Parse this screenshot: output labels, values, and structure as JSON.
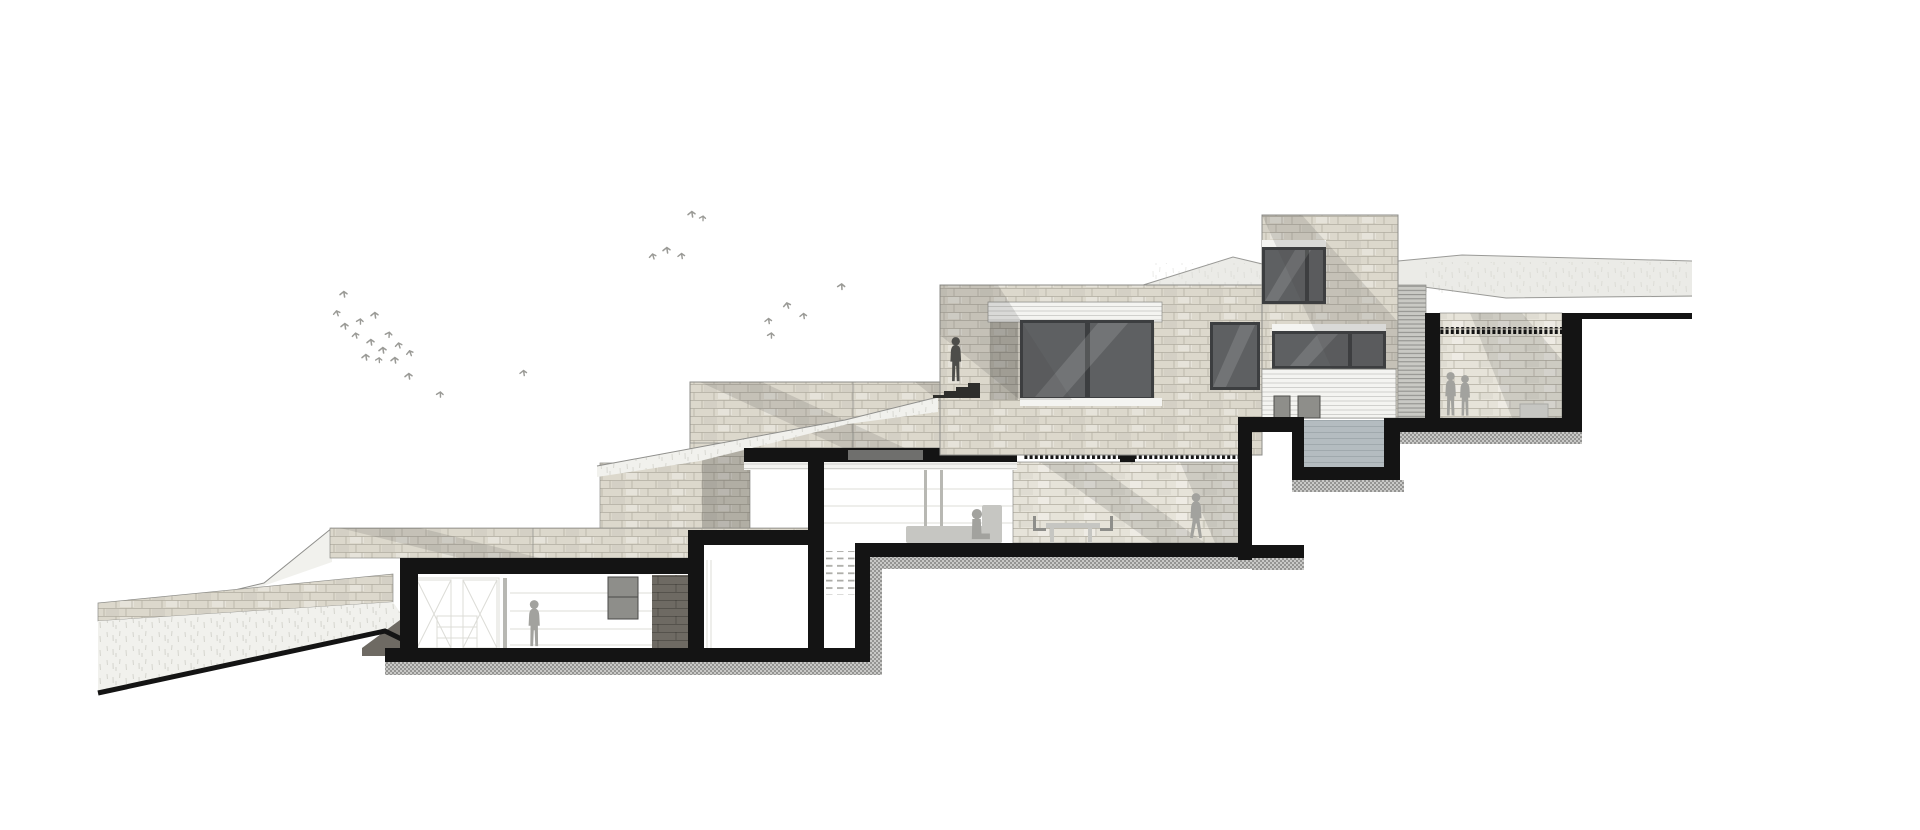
{
  "title": "Stepped hillside house — sectional elevation drawing",
  "drawing_type": "architectural-section",
  "canvas": {
    "width": 1920,
    "height": 830
  },
  "colors": {
    "paper": "#ffffff",
    "poche": "#141414",
    "stone": "#dcd8cc",
    "stoneLight": "#e6e3d9",
    "stoneDark": "#6e6a63",
    "mortar": "#b1ada0",
    "edge": "#8d8d89",
    "hill": "#ebebe7",
    "hillLine": "#9a9a97",
    "lawn": "#f1f1ed",
    "lawnLine": "#8f8f8c",
    "grassTick": "#c9c9c1",
    "glass": "#5e6062",
    "glassFrame": "#3c3e40",
    "glassStreak": "rgba(255,255,255,0.13)",
    "sill": "#f4f4f1",
    "sidingLine": "#c8c8c4",
    "louver": "#c9c9c4",
    "louverLine": "#8d8d89",
    "water": "#b4bcc0",
    "waterLine": "#9aa3a7",
    "hatchDark": "#949492",
    "hatchLight": "#c9c9c7",
    "person": "#a2a29e",
    "personDark": "#4d4d4a",
    "furniture": "#c6c6c2",
    "furnitureDark": "#8e8e8a",
    "mullion": "#b8b8b3",
    "interiorLine": "#dcdcd7",
    "tread": "#a9a9a4",
    "bird": "#9a9a96",
    "shadow": "rgba(70,70,66,0.15)",
    "shadowDeep": "rgba(40,40,38,0.24)"
  },
  "scene": {
    "levels": [
      {
        "id": "lower-bedroom-level",
        "features": [
          "wardrobe-x-doors",
          "drawer-unit",
          "standing-person",
          "dark-cabinet",
          "shelf-lines"
        ]
      },
      {
        "id": "middle-living-level",
        "features": [
          "open-stair",
          "clerestory-glazing",
          "sofa",
          "seated-person",
          "terrace-stone-wall",
          "walking-person",
          "outdoor-table",
          "guard-railing"
        ]
      },
      {
        "id": "upper-entry-level",
        "features": [
          "large-picture-window",
          "secondary-window",
          "entry-steps",
          "person-on-steps",
          "white-fascia"
        ]
      },
      {
        "id": "stone-tower",
        "features": [
          "upper-window",
          "ribbon-window",
          "lap-siding-base",
          "planter-boxes",
          "louver-screen"
        ]
      },
      {
        "id": "sunken-courtyard",
        "features": [
          "guard-railing",
          "couple-silhouette",
          "bench",
          "stone-back-wall"
        ]
      },
      {
        "id": "pool-terrace",
        "features": [
          "water-basin",
          "service-pit"
        ]
      }
    ],
    "terrain": [
      "background-hill-ridge",
      "terraced-retaining-walls",
      "lawn-slopes",
      "grass-texture",
      "black-ground-line"
    ],
    "people_count": 6,
    "bird_count": 27,
    "people": [
      {
        "id": "person-bedroom",
        "pose": "standing"
      },
      {
        "id": "person-living",
        "pose": "sitting-on-sofa"
      },
      {
        "id": "person-terrace",
        "pose": "walking"
      },
      {
        "id": "person-entry-steps",
        "pose": "standing-dark"
      },
      {
        "id": "person-courtyard-1",
        "pose": "standing"
      },
      {
        "id": "person-courtyard-2",
        "pose": "standing"
      }
    ]
  }
}
